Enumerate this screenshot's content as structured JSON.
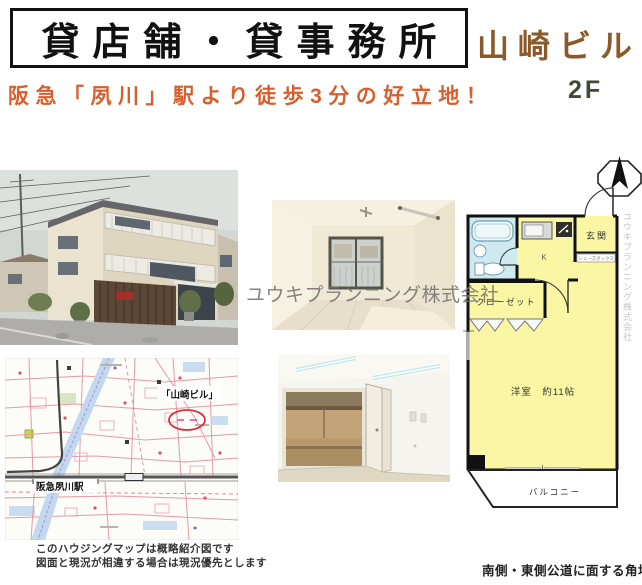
{
  "header": {
    "title": "貸店舗・貸事務所",
    "building_name": "山崎ビル",
    "floor": "2F",
    "catchphrase": "阪急「夙川」駅より徒歩3分の好立地！"
  },
  "watermark": {
    "company": "ユウキプランニング株式会社"
  },
  "floorplan": {
    "entrance_label": "玄関",
    "kitchen_label": "K",
    "closet_label": "クローゼット",
    "shoebox_label": "シューズボックス",
    "main_room_label": "洋室　約11帖",
    "balcony_label": "バルコニー"
  },
  "map": {
    "building_label": "「山崎ビル」",
    "station_label": "阪急夙川駅"
  },
  "footer": {
    "map_note_line1": "このハウジングマップは概略紹介図です",
    "map_note_line2": "図面と現況が相違する場合は現況優先とします",
    "location_note": "南側・東側公道に面する角地"
  },
  "colors": {
    "building_name_text": "#8a5a2a",
    "catchphrase_text": "#d85f2d",
    "floor_text": "#3f4b36",
    "plan_room_fill": "#faf6a3",
    "plan_bath_fill": "#cfe9f1",
    "map_marker_red": "#d93040"
  }
}
